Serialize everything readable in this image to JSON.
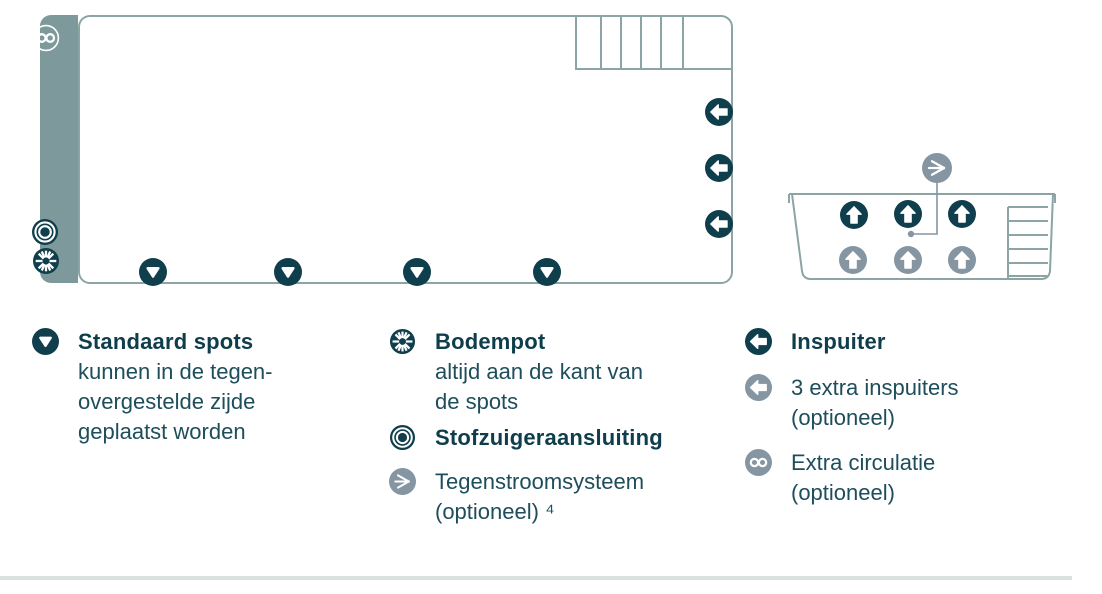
{
  "colors": {
    "dark_teal": "#0F3E4C",
    "gray_icon": "#8595A2",
    "wall_bar": "#7E999B",
    "outline": "#8CA4A4",
    "divider": "#DAE1E1",
    "title_text": "#0E3D4B",
    "body_text": "#1E4D5B"
  },
  "diagram": {
    "main_pool": {
      "left_wall_icons": [
        "infinity-icon",
        "stofzuiger-icon",
        "bodempot-icon"
      ],
      "bottom_spot_count": 4,
      "right_inspuiter_count": 3,
      "ladder_cells": 6
    },
    "tub": {
      "dark_up_arrow_count": 3,
      "gray_up_arrow_count": 3,
      "top_icon": "tegenstroom-icon"
    }
  },
  "legend": {
    "col1": {
      "icon": "spot-down-icon",
      "title": "Standaard spots",
      "lines": [
        "kunnen in de tegen-",
        "overgestelde zijde",
        "geplaatst worden"
      ]
    },
    "col2": {
      "items": [
        {
          "icon": "bodempot-icon",
          "title": "Bodempot",
          "lines": [
            "altijd aan de kant van",
            "de spots"
          ]
        },
        {
          "icon": "stofzuiger-icon",
          "title": "Stofzuigeraansluiting",
          "lines": []
        },
        {
          "icon": "tegenstroom-icon",
          "title": "",
          "lines": [
            "Tegenstroomsysteem",
            "(optioneel) ⁴"
          ]
        }
      ]
    },
    "col3": {
      "items": [
        {
          "icon": "inspuiter-icon",
          "title": "Inspuiter",
          "lines": []
        },
        {
          "icon": "extra-inspuiter-icon",
          "title": "",
          "lines": [
            "3 extra inspuiters",
            "(optioneel)"
          ]
        },
        {
          "icon": "extra-circulatie-icon",
          "title": "",
          "lines": [
            "Extra circulatie",
            "(optioneel)"
          ]
        }
      ]
    }
  }
}
